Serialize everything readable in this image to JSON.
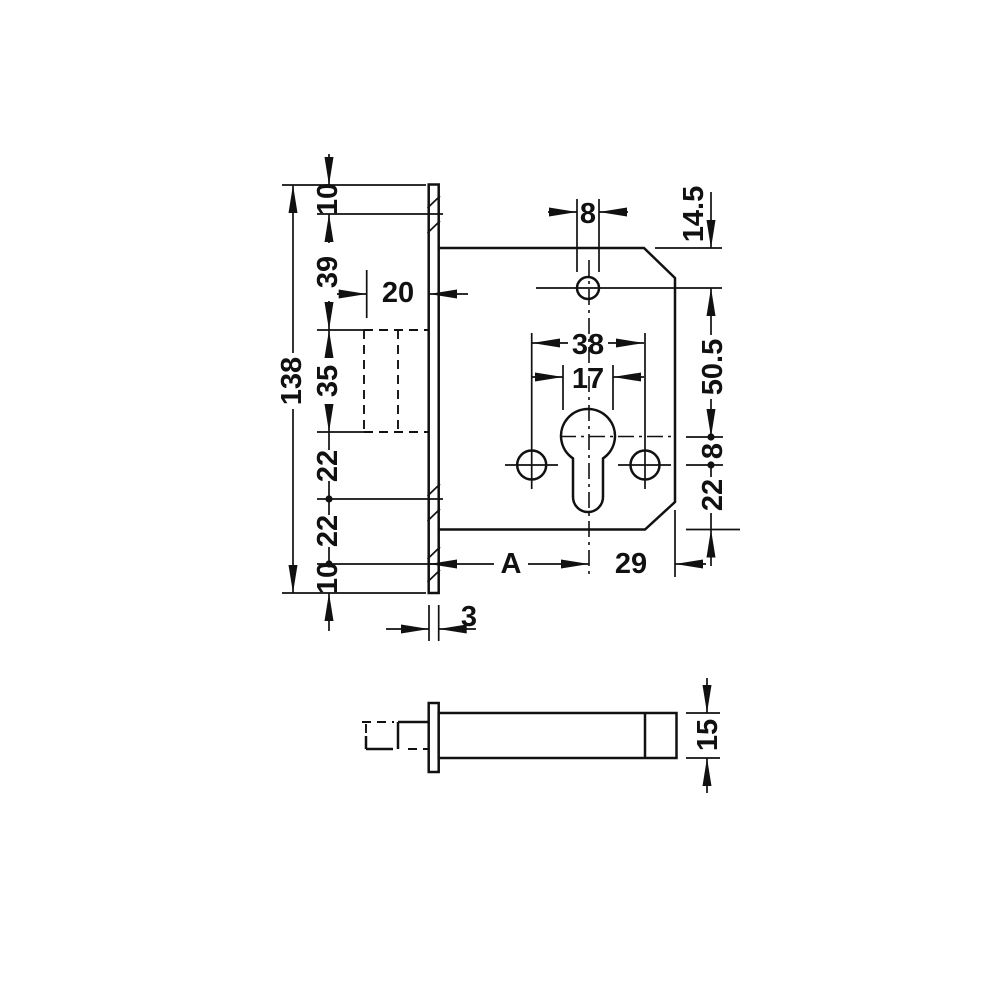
{
  "meta": {
    "background": "#ffffff",
    "ink": "#111111",
    "description": "dimensioned technical drawing of a mortise dead-bolt lock case, front view and side view"
  },
  "front_view": {
    "left_chain": [
      "10",
      "39",
      "35",
      "22",
      "22",
      "10"
    ],
    "overall_height": "138",
    "case_depth": "20",
    "top_hole_width": "8",
    "top_edge_to_hole": "14.5",
    "screw_hole_spacing": "38",
    "cylinder_diameter": "17",
    "hole_to_cylinder": "50.5",
    "cylinder_to_screw_axis": "8",
    "screw_axis_to_bottom": "22",
    "backset": "A",
    "cylinder_to_edge": "29",
    "faceplate_thickness": "3"
  },
  "side_view": {
    "case_thickness": "15"
  }
}
